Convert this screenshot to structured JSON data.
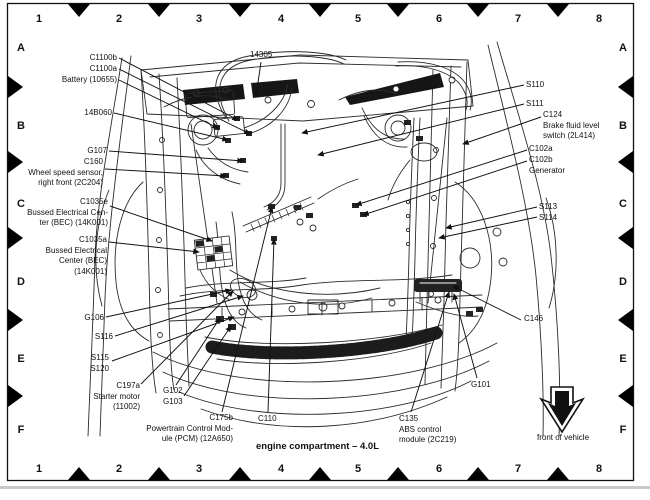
{
  "caption": {
    "title": "engine compartment – 4.0L",
    "front_of_vehicle": "front of vehicle"
  },
  "grid": {
    "columns": [
      "1",
      "2",
      "3",
      "4",
      "5",
      "6",
      "7",
      "8"
    ],
    "rows": [
      "A",
      "B",
      "C",
      "D",
      "E",
      "F"
    ]
  },
  "callouts": {
    "n14305": {
      "lines": [
        "14305"
      ]
    },
    "c1100b": {
      "lines": [
        "C1100b"
      ]
    },
    "c1100a": {
      "lines": [
        "C1100a"
      ]
    },
    "battery": {
      "lines": [
        "Battery (10655)"
      ]
    },
    "n14b060": {
      "lines": [
        "14B060"
      ]
    },
    "g107": {
      "lines": [
        "G107"
      ]
    },
    "c160": {
      "lines": [
        "C160",
        "Wheel speed sensor,",
        "right front (2C204)"
      ]
    },
    "c1035e": {
      "lines": [
        "C1035e",
        "Bussed Electrical Cen-",
        "ter (BEC) (14K001)"
      ]
    },
    "c1035a": {
      "lines": [
        "C1035a",
        "Bussed Electrical",
        "Center (BEC)",
        "(14K001)"
      ]
    },
    "g106": {
      "lines": [
        "G106"
      ]
    },
    "s116": {
      "lines": [
        "S116"
      ]
    },
    "s115_s120": {
      "lines": [
        "S115",
        "S120"
      ]
    },
    "c197a": {
      "lines": [
        "C197a",
        "Starter motor",
        "(11002)"
      ]
    },
    "g102_g103": {
      "lines": [
        "G102",
        "G103"
      ]
    },
    "c175b": {
      "lines": [
        "C175b",
        "Powertrain Control Mod-",
        "ule (PCM) (12A650)"
      ]
    },
    "c110": {
      "lines": [
        "C110"
      ]
    },
    "c135": {
      "lines": [
        "C135",
        "ABS control",
        "module (2C219)"
      ]
    },
    "g101": {
      "lines": [
        "G101"
      ]
    },
    "c146": {
      "lines": [
        "C146"
      ]
    },
    "s113_s114": {
      "lines": [
        "S113",
        "S114"
      ]
    },
    "c102a": {
      "lines": [
        "C102a"
      ]
    },
    "c102b": {
      "lines": [
        "C102b",
        "Generator"
      ]
    },
    "c124": {
      "lines": [
        "C124",
        "Brake fluid level",
        "switch (2L414)"
      ]
    },
    "s111": {
      "lines": [
        "S111"
      ]
    },
    "s110": {
      "lines": [
        "S110"
      ]
    }
  },
  "colors": {
    "ink": "#111111",
    "paper": "#ffffff"
  }
}
